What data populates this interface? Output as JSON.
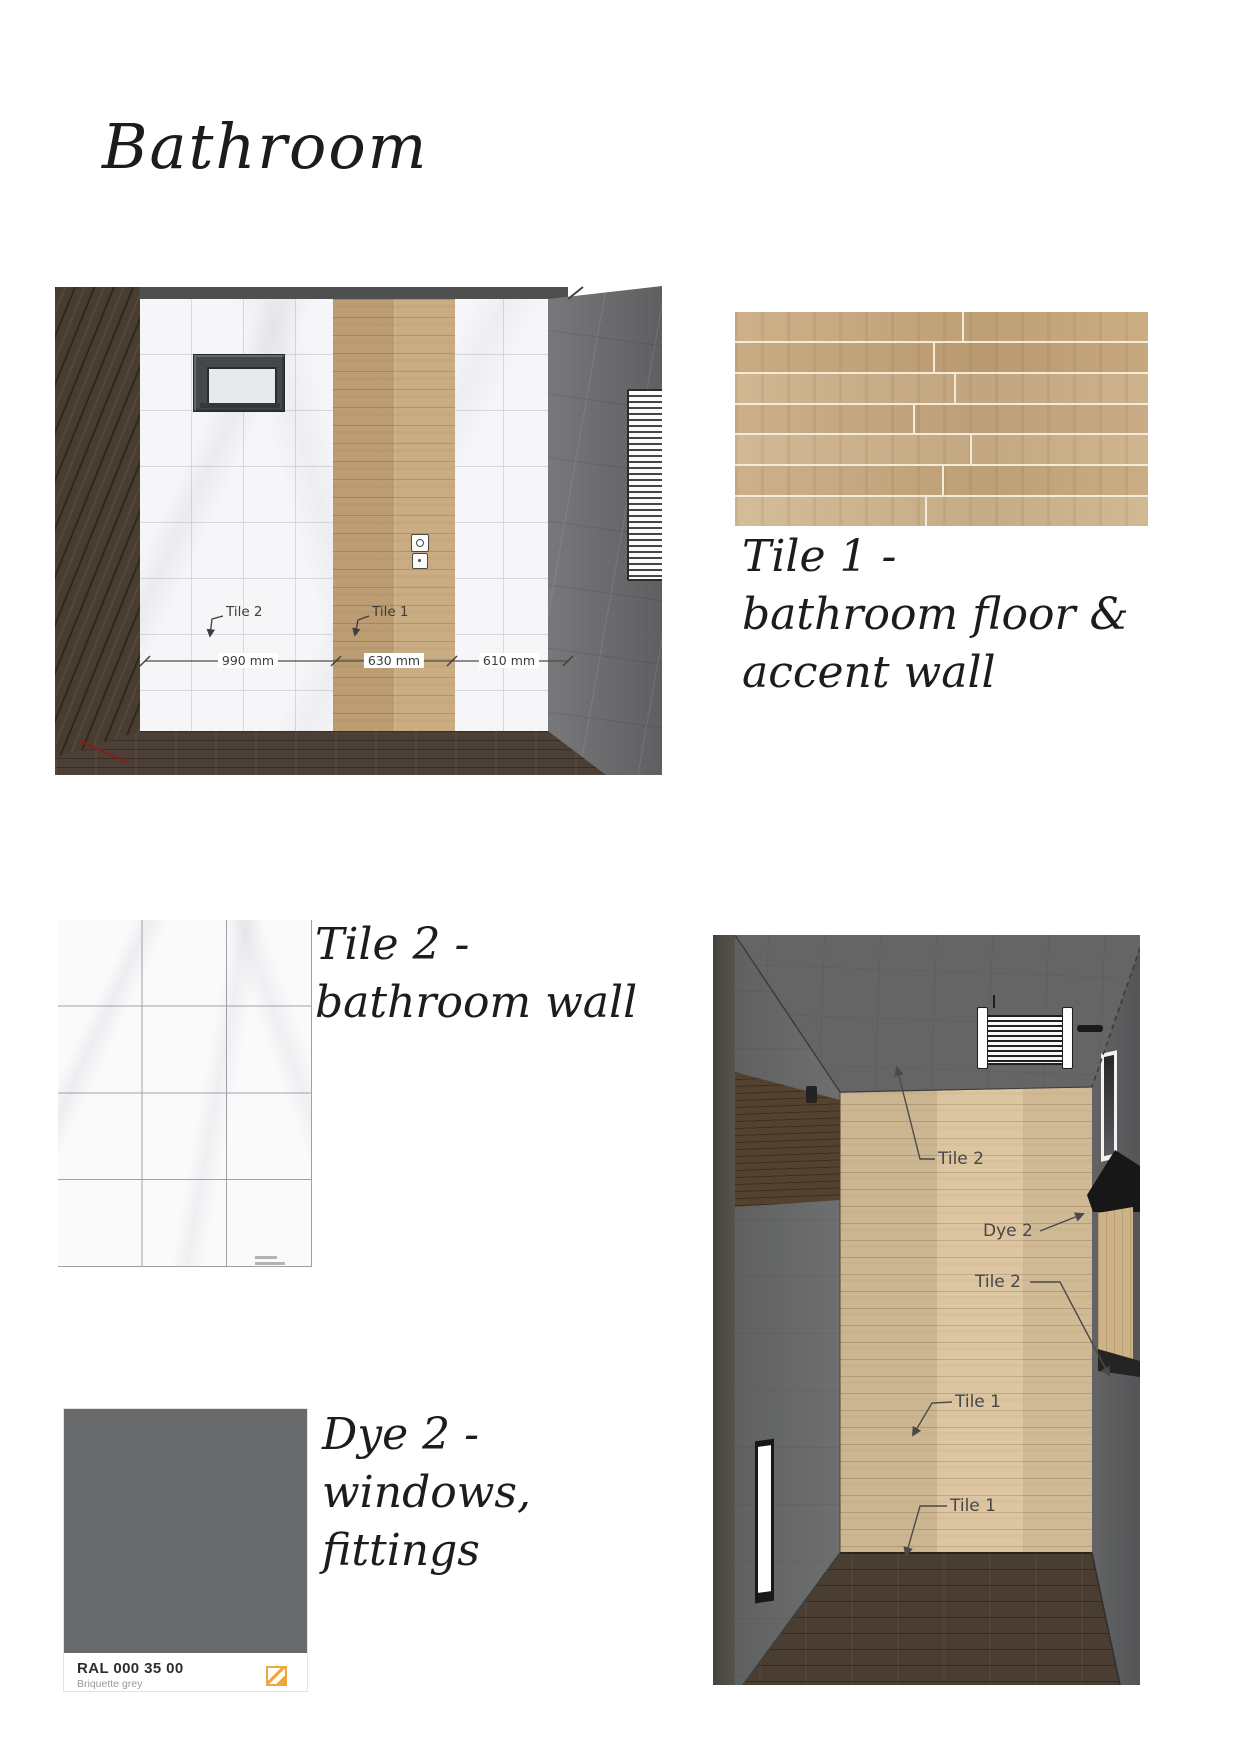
{
  "page": {
    "title": "Bathroom"
  },
  "elevation": {
    "tile2_label": "Tile 2",
    "tile1_label": "Tile 1",
    "dims": [
      "990 mm",
      "630 mm",
      "610 mm"
    ]
  },
  "swatch_tile1": {
    "caption": [
      "Tile 1 -",
      "bathroom floor &",
      "accent wall"
    ]
  },
  "swatch_tile2": {
    "caption": [
      "Tile 2 -",
      "bathroom wall"
    ]
  },
  "swatch_dye2": {
    "caption": [
      "Dye 2 -",
      "windows,",
      "fittings"
    ],
    "code": "RAL 000 35 00",
    "name": "Briquette grey"
  },
  "render": {
    "labels": [
      {
        "text": "Tile 2"
      },
      {
        "text": "Dye 2"
      },
      {
        "text": "Tile 2"
      },
      {
        "text": "Tile 1"
      },
      {
        "text": "Tile 1"
      }
    ]
  },
  "colors": {
    "briquette_grey": "#696a6b",
    "ral_orange": "#eda73f",
    "wood_tile": "#c9a97f",
    "marble_tile": "#fafafb"
  }
}
